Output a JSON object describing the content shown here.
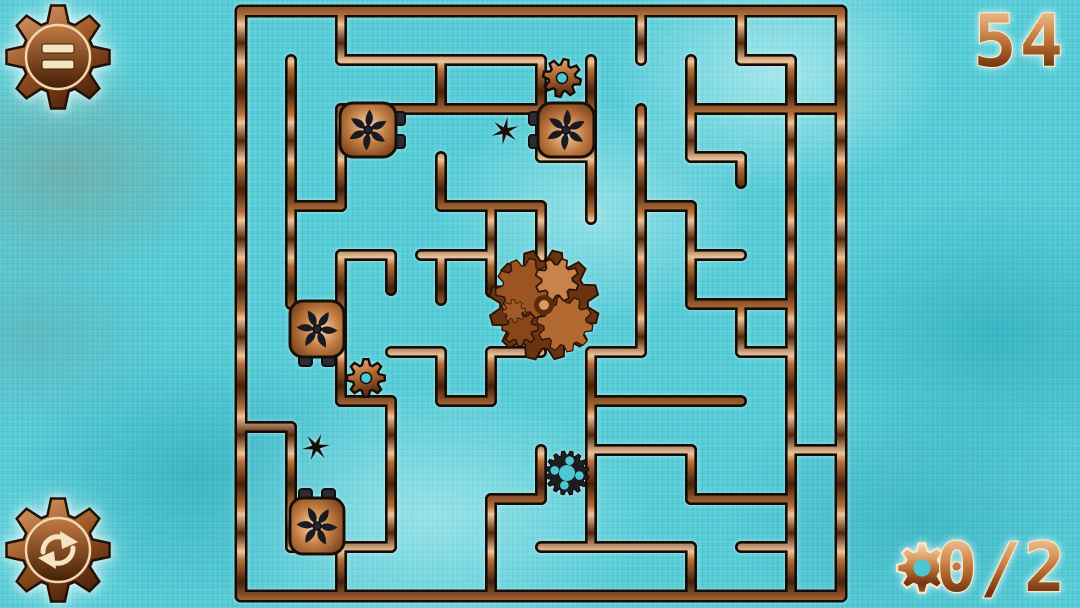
{
  "hud": {
    "timer_value": "54",
    "collect_counter": {
      "value": "0/2",
      "icon": "gear-icon"
    },
    "menu_button": {
      "icon": "menu-pause-icon"
    },
    "restart_button": {
      "icon": "restart-arrows-icon"
    }
  },
  "colors": {
    "background_teal": "#55ced9",
    "copper_light": "#f0c092",
    "copper_mid": "#b36a30",
    "copper_dark": "#3a1c08",
    "wall_outline": "#140c06",
    "cream_outline": "#f5e8cc",
    "obstacle_dark": "#1d1d20"
  },
  "maze": {
    "outer": {
      "x1": 241,
      "y1": 11,
      "x2": 841,
      "y2": 596
    },
    "walls": [
      [
        241,
        11,
        841,
        11
      ],
      [
        241,
        596,
        841,
        596
      ],
      [
        241,
        11,
        241,
        596
      ],
      [
        841,
        11,
        841,
        596
      ],
      [
        291,
        60,
        291,
        304
      ],
      [
        291,
        206,
        341,
        206
      ],
      [
        341,
        11,
        341,
        60
      ],
      [
        341,
        60,
        541,
        60
      ],
      [
        441,
        60,
        441,
        109
      ],
      [
        341,
        109,
        591,
        109
      ],
      [
        341,
        109,
        341,
        206
      ],
      [
        541,
        60,
        541,
        157
      ],
      [
        591,
        60,
        591,
        219
      ],
      [
        541,
        157,
        591,
        157
      ],
      [
        641,
        11,
        641,
        60
      ],
      [
        741,
        11,
        741,
        60
      ],
      [
        741,
        60,
        791,
        60
      ],
      [
        791,
        60,
        791,
        596
      ],
      [
        691,
        109,
        841,
        109
      ],
      [
        691,
        60,
        691,
        157
      ],
      [
        691,
        157,
        741,
        157
      ],
      [
        741,
        157,
        741,
        183
      ],
      [
        641,
        109,
        641,
        352
      ],
      [
        641,
        206,
        691,
        206
      ],
      [
        691,
        206,
        691,
        304
      ],
      [
        691,
        255,
        741,
        255
      ],
      [
        691,
        304,
        791,
        304
      ],
      [
        741,
        304,
        741,
        352
      ],
      [
        741,
        352,
        791,
        352
      ],
      [
        441,
        206,
        541,
        206
      ],
      [
        441,
        157,
        441,
        206
      ],
      [
        541,
        206,
        541,
        258
      ],
      [
        341,
        255,
        391,
        255
      ],
      [
        341,
        255,
        341,
        401
      ],
      [
        391,
        255,
        391,
        290
      ],
      [
        421,
        255,
        491,
        255
      ],
      [
        491,
        206,
        491,
        292
      ],
      [
        441,
        255,
        441,
        300
      ],
      [
        391,
        352,
        441,
        352
      ],
      [
        441,
        352,
        441,
        401
      ],
      [
        441,
        401,
        491,
        401
      ],
      [
        341,
        401,
        391,
        401
      ],
      [
        391,
        401,
        391,
        547
      ],
      [
        491,
        352,
        491,
        401
      ],
      [
        491,
        352,
        541,
        352
      ],
      [
        591,
        401,
        741,
        401
      ],
      [
        591,
        352,
        591,
        547
      ],
      [
        591,
        352,
        641,
        352
      ],
      [
        241,
        427,
        291,
        427
      ],
      [
        291,
        427,
        291,
        547
      ],
      [
        291,
        547,
        391,
        547
      ],
      [
        341,
        547,
        341,
        596
      ],
      [
        591,
        450,
        691,
        450
      ],
      [
        691,
        450,
        691,
        499
      ],
      [
        691,
        499,
        791,
        499
      ],
      [
        791,
        450,
        841,
        450
      ],
      [
        541,
        450,
        541,
        499
      ],
      [
        491,
        499,
        541,
        499
      ],
      [
        491,
        499,
        491,
        596
      ],
      [
        541,
        547,
        691,
        547
      ],
      [
        691,
        547,
        691,
        596
      ],
      [
        741,
        547,
        791,
        547
      ]
    ],
    "objects": [
      {
        "type": "fanbox",
        "name": "fan-obstacle-1",
        "x": 368,
        "y": 130,
        "rot": 0
      },
      {
        "type": "fanbox",
        "name": "fan-obstacle-2",
        "x": 566,
        "y": 130,
        "rot": 180
      },
      {
        "type": "fanbox",
        "name": "fan-obstacle-3",
        "x": 317,
        "y": 329,
        "rot": 90
      },
      {
        "type": "fanbox",
        "name": "fan-obstacle-4",
        "x": 317,
        "y": 526,
        "rot": 270
      },
      {
        "type": "gear",
        "name": "gear-pickup-1",
        "x": 562,
        "y": 78,
        "rot": 12
      },
      {
        "type": "gear",
        "name": "gear-pickup-2",
        "x": 366,
        "y": 378,
        "rot": 0
      },
      {
        "type": "star",
        "name": "spike-star-1",
        "x": 505,
        "y": 131,
        "rot": 10
      },
      {
        "type": "star",
        "name": "spike-star-2",
        "x": 316,
        "y": 447,
        "rot": 22
      },
      {
        "type": "sprocket",
        "name": "dark-sprocket",
        "x": 567,
        "y": 473,
        "rot": 12
      },
      {
        "type": "player",
        "name": "player-gear-cluster",
        "x": 544,
        "y": 305,
        "rot": 0
      }
    ]
  }
}
